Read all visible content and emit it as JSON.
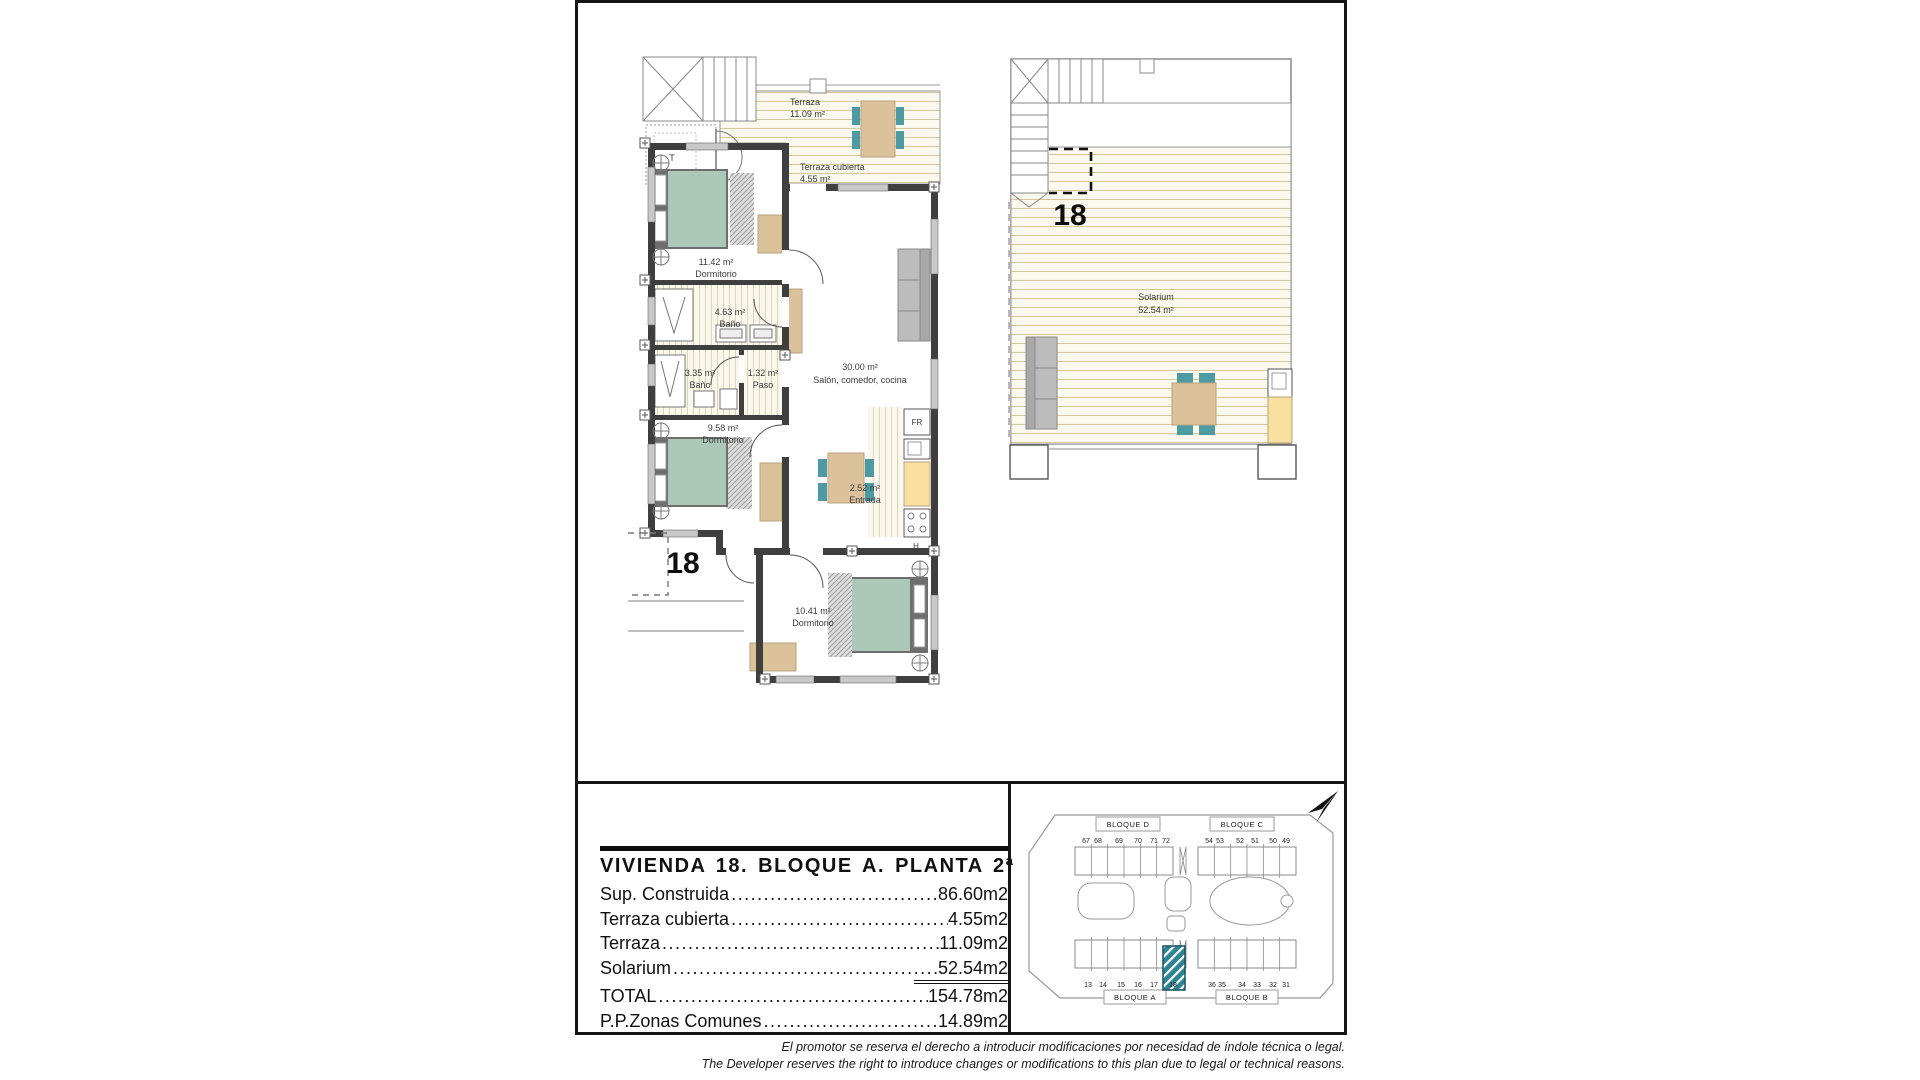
{
  "sheet": {
    "main_plan": {
      "terraza": {
        "name": "Terraza",
        "area": "11.09 m²"
      },
      "terraza_cubierta": {
        "name": "Terraza cubierta",
        "area": "4.55 m²"
      },
      "dormitorio_1": {
        "area": "11.42 m²",
        "name": "Dormitorio"
      },
      "bano_1": {
        "area": "4.63 m²",
        "name": "Baño"
      },
      "bano_2": {
        "area": "3.35 m²",
        "name": "Baño"
      },
      "paso": {
        "area": "1.32 m²",
        "name": "Paso"
      },
      "salon": {
        "area": "30.00 m²",
        "name": "Salón, comedor, cocina"
      },
      "dormitorio_2": {
        "area": "9.58 m²",
        "name": "Dormitorio"
      },
      "entrada": {
        "area": "2.52 m²",
        "name": "Entrada"
      },
      "dormitorio_3": {
        "area": "10.41 m²",
        "name": "Dormitorio"
      },
      "fridge_label": "FR",
      "hob_label": "H",
      "storage_label": "T",
      "unit_number": "18"
    },
    "solarium_plan": {
      "unit_number": "18",
      "name": "Solarium",
      "area": "52.54 m²"
    },
    "area_table": {
      "title": "VIVIENDA 18. BLOQUE A. PLANTA 2ª",
      "rows": [
        {
          "label": "Sup. Construida",
          "value": "86.60m2"
        },
        {
          "label": "Terraza cubierta",
          "value": "4.55m2"
        },
        {
          "label": "Terraza",
          "value": "11.09m2"
        },
        {
          "label": "Solarium",
          "value": "52.54m2",
          "underline": true
        },
        {
          "label": "TOTAL",
          "value": "154.78m2"
        },
        {
          "label": "P.P.Zonas Comunes",
          "value": "14.89m2"
        }
      ]
    },
    "site_plan": {
      "blocks": {
        "bloque_d": "BLOQUE D",
        "bloque_c": "BLOQUE C",
        "bloque_a": "BLOQUE A",
        "bloque_b": "BLOQUE B"
      },
      "units": {
        "top_left": [
          "67",
          "68",
          "69",
          "70",
          "71",
          "72"
        ],
        "top_right": [
          "54",
          "53",
          "52",
          "51",
          "50",
          "49"
        ],
        "bottom_left": [
          "13",
          "14",
          "15",
          "16",
          "17",
          "18"
        ],
        "bottom_right": [
          "36",
          "35",
          "34",
          "33",
          "32",
          "31"
        ]
      },
      "highlighted_unit": "18"
    },
    "disclaimer": {
      "es": "El promotor se reserva el derecho a introducir modificaciones por necesidad de índole técnica o legal.",
      "en": "The Developer reserves the right to introduce changes or modifications to this plan due to legal or technical reasons."
    },
    "colors": {
      "wall": "#3f3f3f",
      "window": "#c8c8c8",
      "bed": "#abc8b8",
      "wood": "#dcc29b",
      "deck_line": "#d3c89f",
      "kitchen_counter": "#f9e0a0",
      "chair": "#4e9aa2",
      "sofa": "#bcbcbc",
      "site_highlight": "#2e8495",
      "ink": "#111111"
    }
  }
}
